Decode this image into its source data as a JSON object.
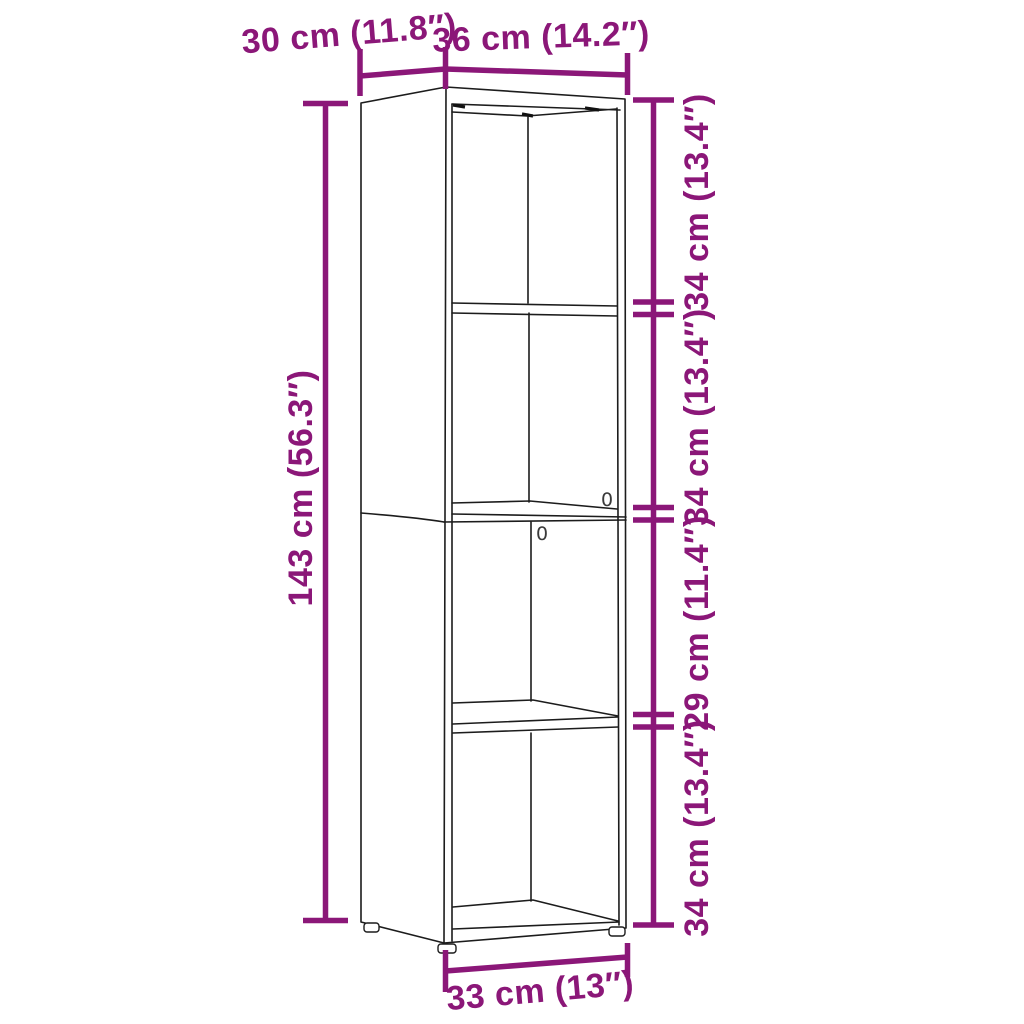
{
  "colors": {
    "accent_dimension": "#8B1778",
    "drawing_line": "#1C1C1C",
    "background": "#FFFFFF"
  },
  "diagram": {
    "labels": {
      "depth_top": "30 cm (11.8″)",
      "width_top": "36 cm (14.2″)",
      "height_left": "143 cm (56.3″)",
      "section_top": "34 cm (13.4″)",
      "section_upper_middle": "34 cm (13.4″)",
      "section_lower_middle": "29 cm (11.4″)",
      "section_bottom": "34 cm (13.4″)",
      "width_bottom": "33 cm (13″)"
    },
    "hole_marks": {
      "upper": "0",
      "lower": "0"
    }
  }
}
